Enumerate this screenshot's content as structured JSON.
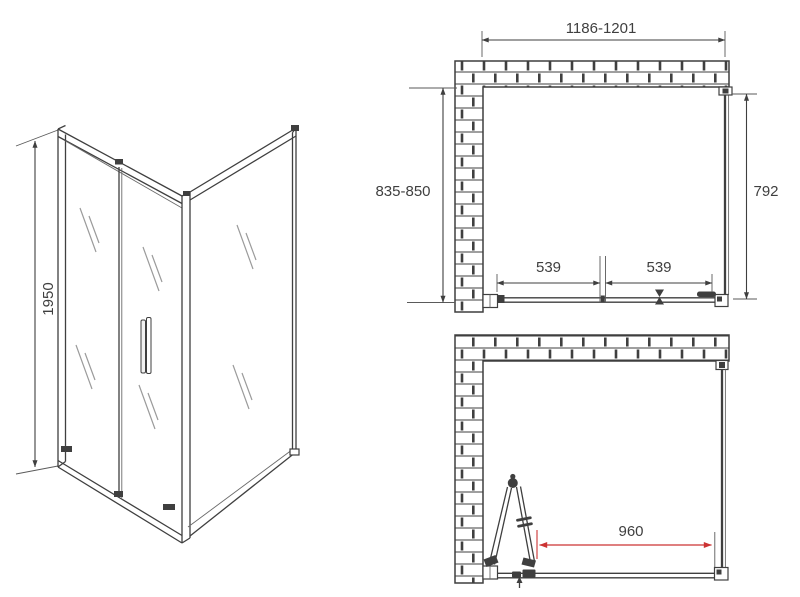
{
  "colors": {
    "line": "#3f3f3f",
    "accent_red": "#cc3333",
    "background": "#ffffff"
  },
  "perspective_view": {
    "height_label": "1950"
  },
  "top_plan_view": {
    "overall_width_label": "1186-1201",
    "depth_range_label": "835-850",
    "side_panel_label": "792",
    "door_panel_left_label": "539",
    "door_panel_right_label": "539"
  },
  "open_door_plan_view": {
    "walk_in_width_label": "960"
  }
}
